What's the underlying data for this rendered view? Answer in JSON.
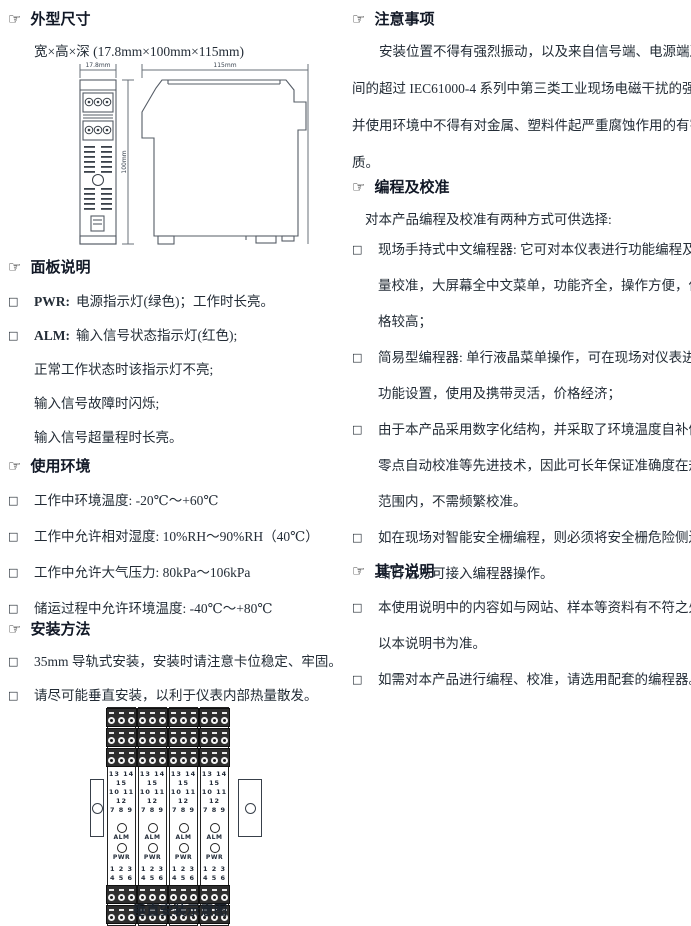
{
  "glyphs": {
    "hand": "☞",
    "bullet": "□"
  },
  "left": {
    "dimensions": {
      "title": "外型尺寸",
      "subtitle": "宽×高×深 (17.8mm×100mm×115mm)",
      "drawing": {
        "width_label": "17.8mm",
        "height_label": "100mm",
        "depth_label": "115mm"
      }
    },
    "panel": {
      "title": "面板说明",
      "items": [
        {
          "prefix": "PWR:",
          "rest": "电源指示灯(绿色)；工作时长亮。",
          "lines": []
        },
        {
          "prefix": "ALM:",
          "rest": "输入信号状态指示灯(红色);",
          "lines": [
            "正常工作状态时该指示灯不亮;",
            "输入信号故障时闪烁;",
            "输入信号超量程时长亮。"
          ]
        }
      ]
    },
    "environment": {
      "title": "使用环境",
      "items": [
        "工作中环境温度: -20℃～+60℃",
        "工作中允许相对湿度: 10%RH～90%RH（40℃）",
        "工作中允许大气压力: 80kPa～106kPa",
        "储运过程中允许环境温度: -40℃～+80℃"
      ]
    },
    "install": {
      "title": "安装方法",
      "items": [
        "35mm 导轨式安装，安装时请注意卡位稳定、牢固。",
        "请尽可能垂直安装，以利于仪表内部热量散发。"
      ],
      "diagram": {
        "caption": "垂直安装示意图",
        "module": {
          "top_numbers": [
            "13 14 15",
            "10 11 12",
            "7 8 9"
          ],
          "alm_label": "ALM",
          "pwr_label": "PWR",
          "bottom_numbers": [
            "1 2 3",
            "4 5 6"
          ]
        }
      }
    }
  },
  "right": {
    "notice": {
      "title": "注意事项",
      "lines": [
        "安装位置不得有强烈振动，以及来自信号端、电源端及空",
        "间的超过 IEC61000-4 系列中第三类工业现场电磁干扰的强度，",
        "并使用环境中不得有对金属、塑料件起严重腐蚀作用的有害物",
        "质。"
      ]
    },
    "programming": {
      "title": "编程及校准",
      "intro": "对本产品编程及校准有两种方式可供选择:",
      "items": [
        {
          "lines": [
            "现场手持式中文编程器: 它可对本仪表进行功能编程及计",
            "量校准，大屏幕全中文菜单，功能齐全，操作方便，但价",
            "格较高；"
          ]
        },
        {
          "lines": [
            "简易型编程器: 单行液晶菜单操作，可在现场对仪表进行",
            "功能设置，使用及携带灵活，价格经济；"
          ]
        },
        {
          "lines": [
            "由于本产品采用数字化结构，并采取了环境温度自补偿、",
            "零点自动校准等先进技术，因此可长年保证准确度在规定",
            "范围内，不需频繁校准。"
          ]
        },
        {
          "lines": [
            "如在现场对智能安全栅编程，则必须将安全栅危险侧连线",
            "断开后方可接入编程器操作。"
          ]
        }
      ]
    },
    "other": {
      "title": "其它说明",
      "items": [
        {
          "lines": [
            "本使用说明中的内容如与网站、样本等资料有不符之处，",
            "以本说明书为准。"
          ]
        },
        {
          "lines": [
            "如需对本产品进行编程、校准，请选用配套的编程器。"
          ]
        }
      ]
    }
  }
}
